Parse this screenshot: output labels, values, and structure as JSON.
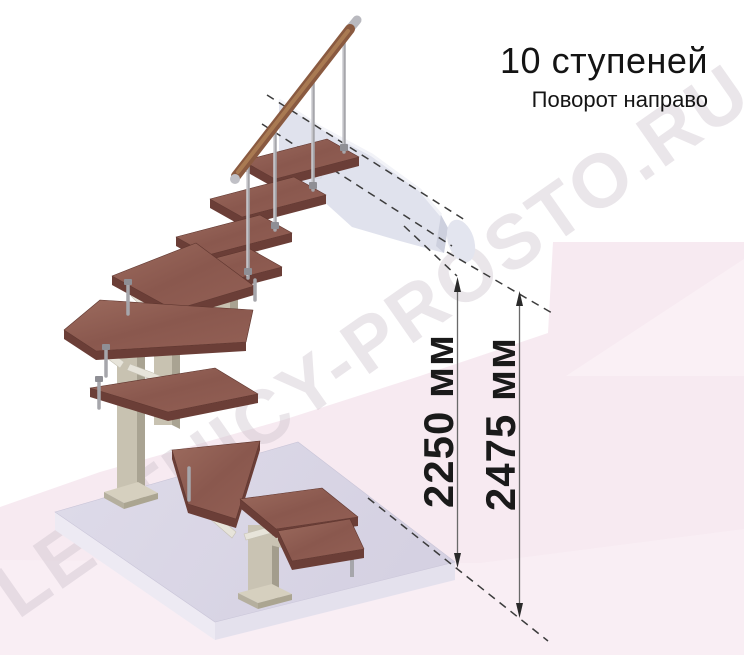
{
  "header": {
    "title": "10 ступеней",
    "subtitle": "Поворот направо"
  },
  "dimension_labels": [
    {
      "id": "to-top-step",
      "label": "2250 мм"
    },
    {
      "id": "total-height",
      "label": "2475 мм"
    }
  ],
  "watermark": {
    "text": "LESTNICY-PROSTO.RU"
  },
  "diagram": {
    "type": "isometric-staircase-render",
    "steps_count": 10,
    "turn": "right",
    "colors": {
      "tread_top": "#8f5d52",
      "tread_edge": "#6b3e37",
      "handrail_wood": "#8a5a40",
      "metal_baluster": "#a6a6ab",
      "support_column": "#c8c2b1",
      "base_platform": "#d9d5e4",
      "wall_panel": "#e0e2ed",
      "background_accent": "#f7eaf1",
      "text": "#1a1a1a"
    }
  }
}
